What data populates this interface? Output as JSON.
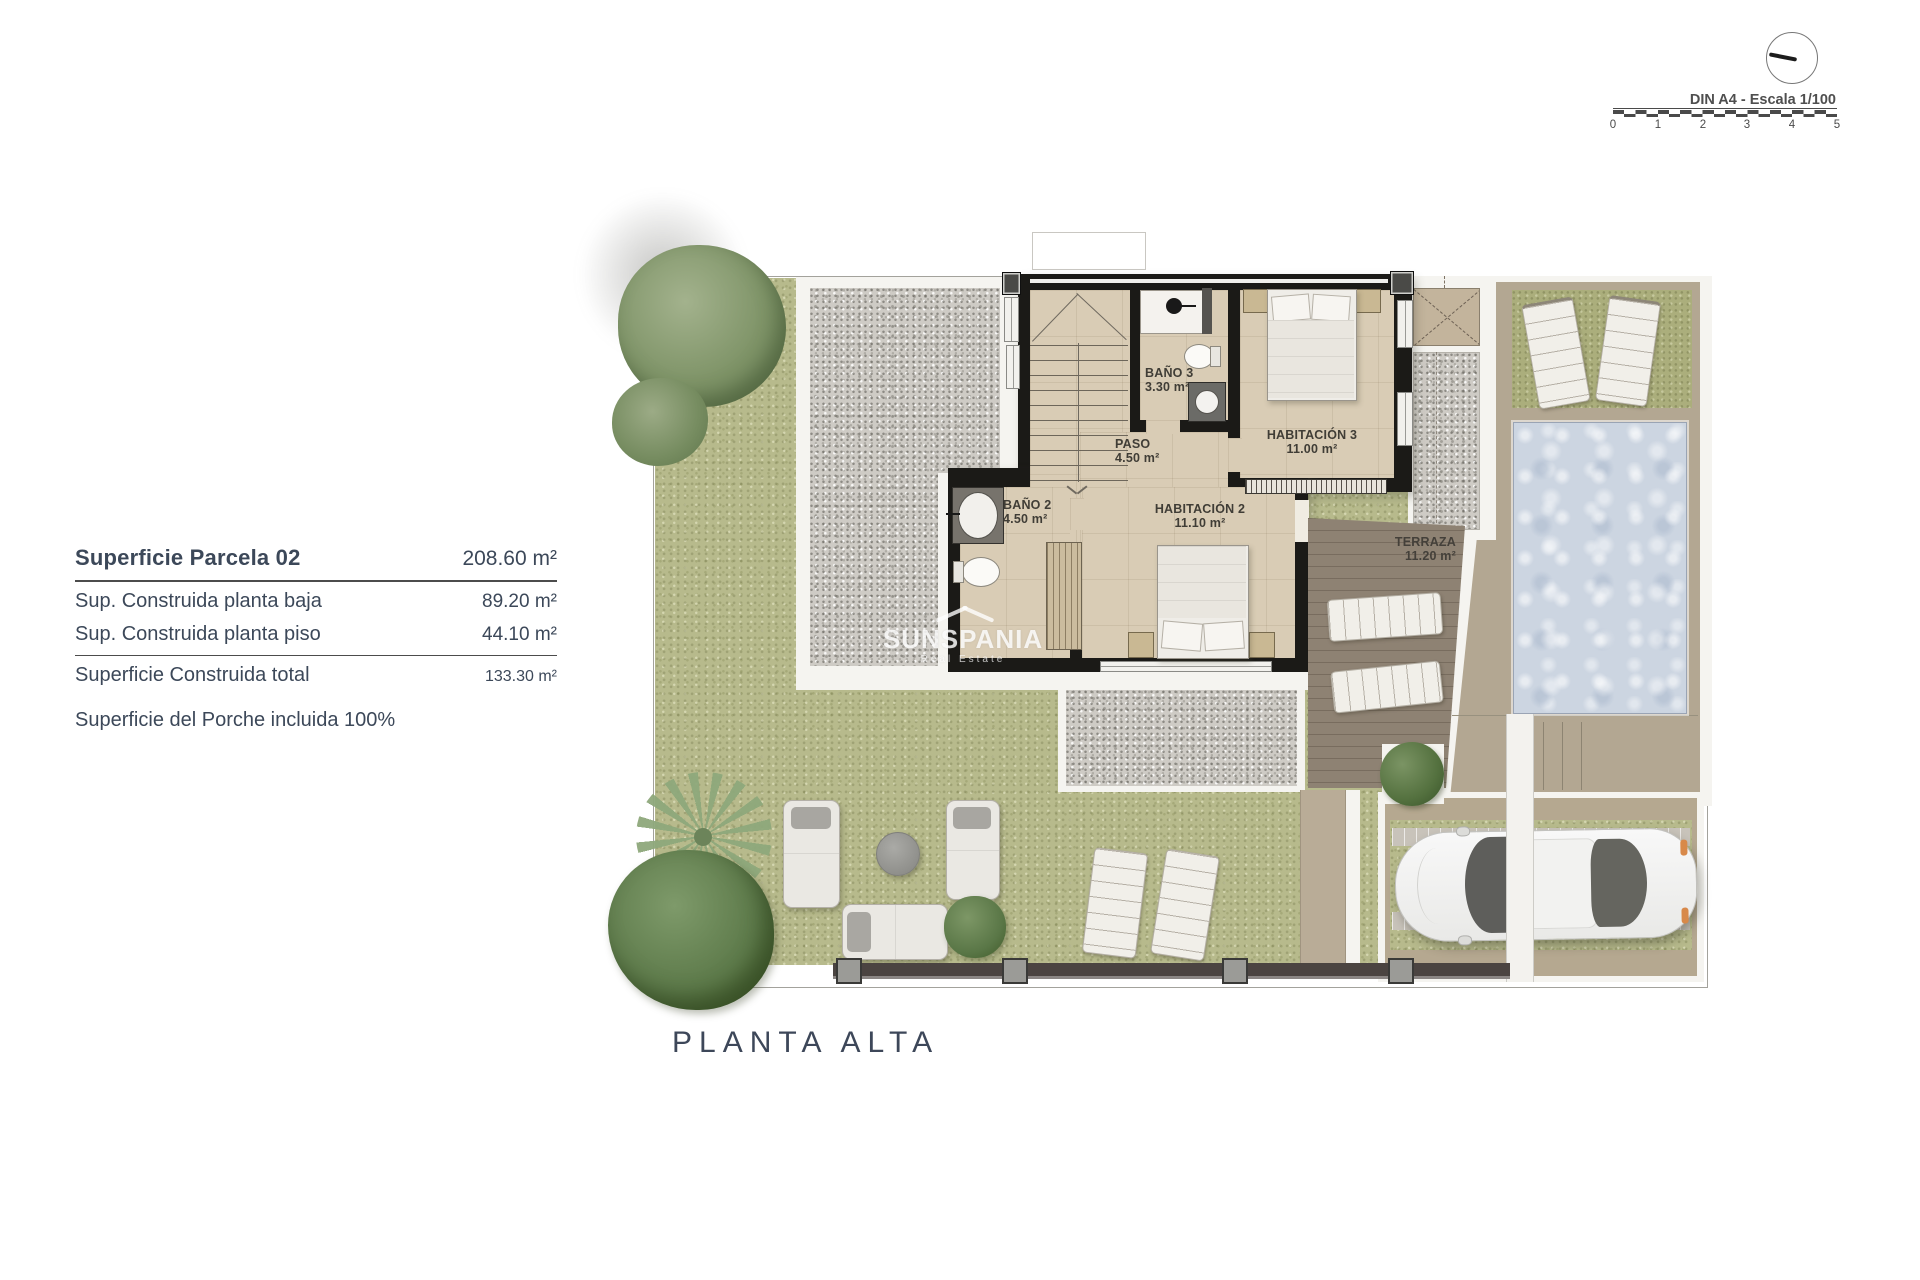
{
  "info_panel": {
    "title_label": "Superficie Parcela 02",
    "title_value": "208.60 m²",
    "rows": [
      {
        "label": "Sup. Construida planta baja",
        "value": "89.20 m²"
      },
      {
        "label": "Sup. Construida planta piso",
        "value": "44.10 m²"
      }
    ],
    "total_label": "Superficie Construida total",
    "total_value": "133.30 m²",
    "note": "Superficie del Porche incluida 100%"
  },
  "scale_bar": {
    "label": "DIN A4 - Escala 1/100",
    "ticks": [
      "0",
      "1",
      "2",
      "3",
      "4",
      "5"
    ]
  },
  "plan": {
    "title": "PLANTA ALTA",
    "watermark_name": "SUNSPANIA",
    "watermark_sub": "Real Estate",
    "rooms": {
      "bano3": {
        "name": "BAÑO 3",
        "area": "3.30 m²"
      },
      "paso": {
        "name": "PASO",
        "area": "4.50 m²"
      },
      "habitacion3": {
        "name": "HABITACIÓN 3",
        "area": "11.00 m²"
      },
      "bano2": {
        "name": "BAÑO 2",
        "area": "4.50 m²"
      },
      "habitacion2": {
        "name": "HABITACIÓN 2",
        "area": "11.10 m²"
      },
      "terraza": {
        "name": "TERRAZA",
        "area": "11.20 m²"
      }
    },
    "colors": {
      "grass": "#b7ba8c",
      "gravel": "#cecbc5",
      "interior_floor": "#d9ccb5",
      "terrace": "#8e8273",
      "pool_water": "#ccd5e1",
      "wall": "#1b1a17",
      "text_navy": "#3c4859"
    }
  }
}
